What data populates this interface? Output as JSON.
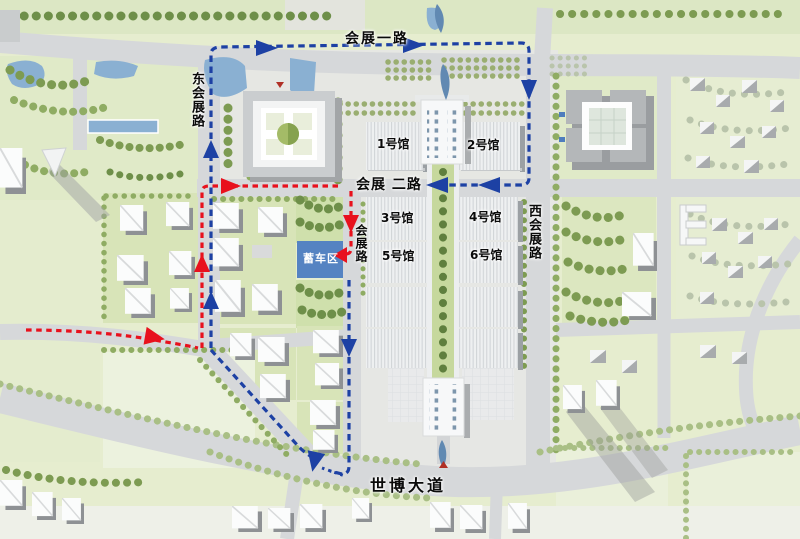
{
  "map": {
    "roads": {
      "north_road": "会展一路",
      "east_road": "东会展路",
      "middle_road": "会展 二路",
      "west_road": "西会展路",
      "center_road": "会展路",
      "south_avenue": "世博大道"
    },
    "halls": [
      {
        "label": "1号馆"
      },
      {
        "label": "2号馆"
      },
      {
        "label": "3号馆"
      },
      {
        "label": "4号馆"
      },
      {
        "label": "5号馆"
      },
      {
        "label": "6号馆"
      }
    ],
    "staging_area": {
      "label": "蓄车区",
      "fill": "#5583c2"
    },
    "routes": {
      "blue_route_color": "#1d41a4",
      "red_route_color": "#e8111d"
    }
  }
}
